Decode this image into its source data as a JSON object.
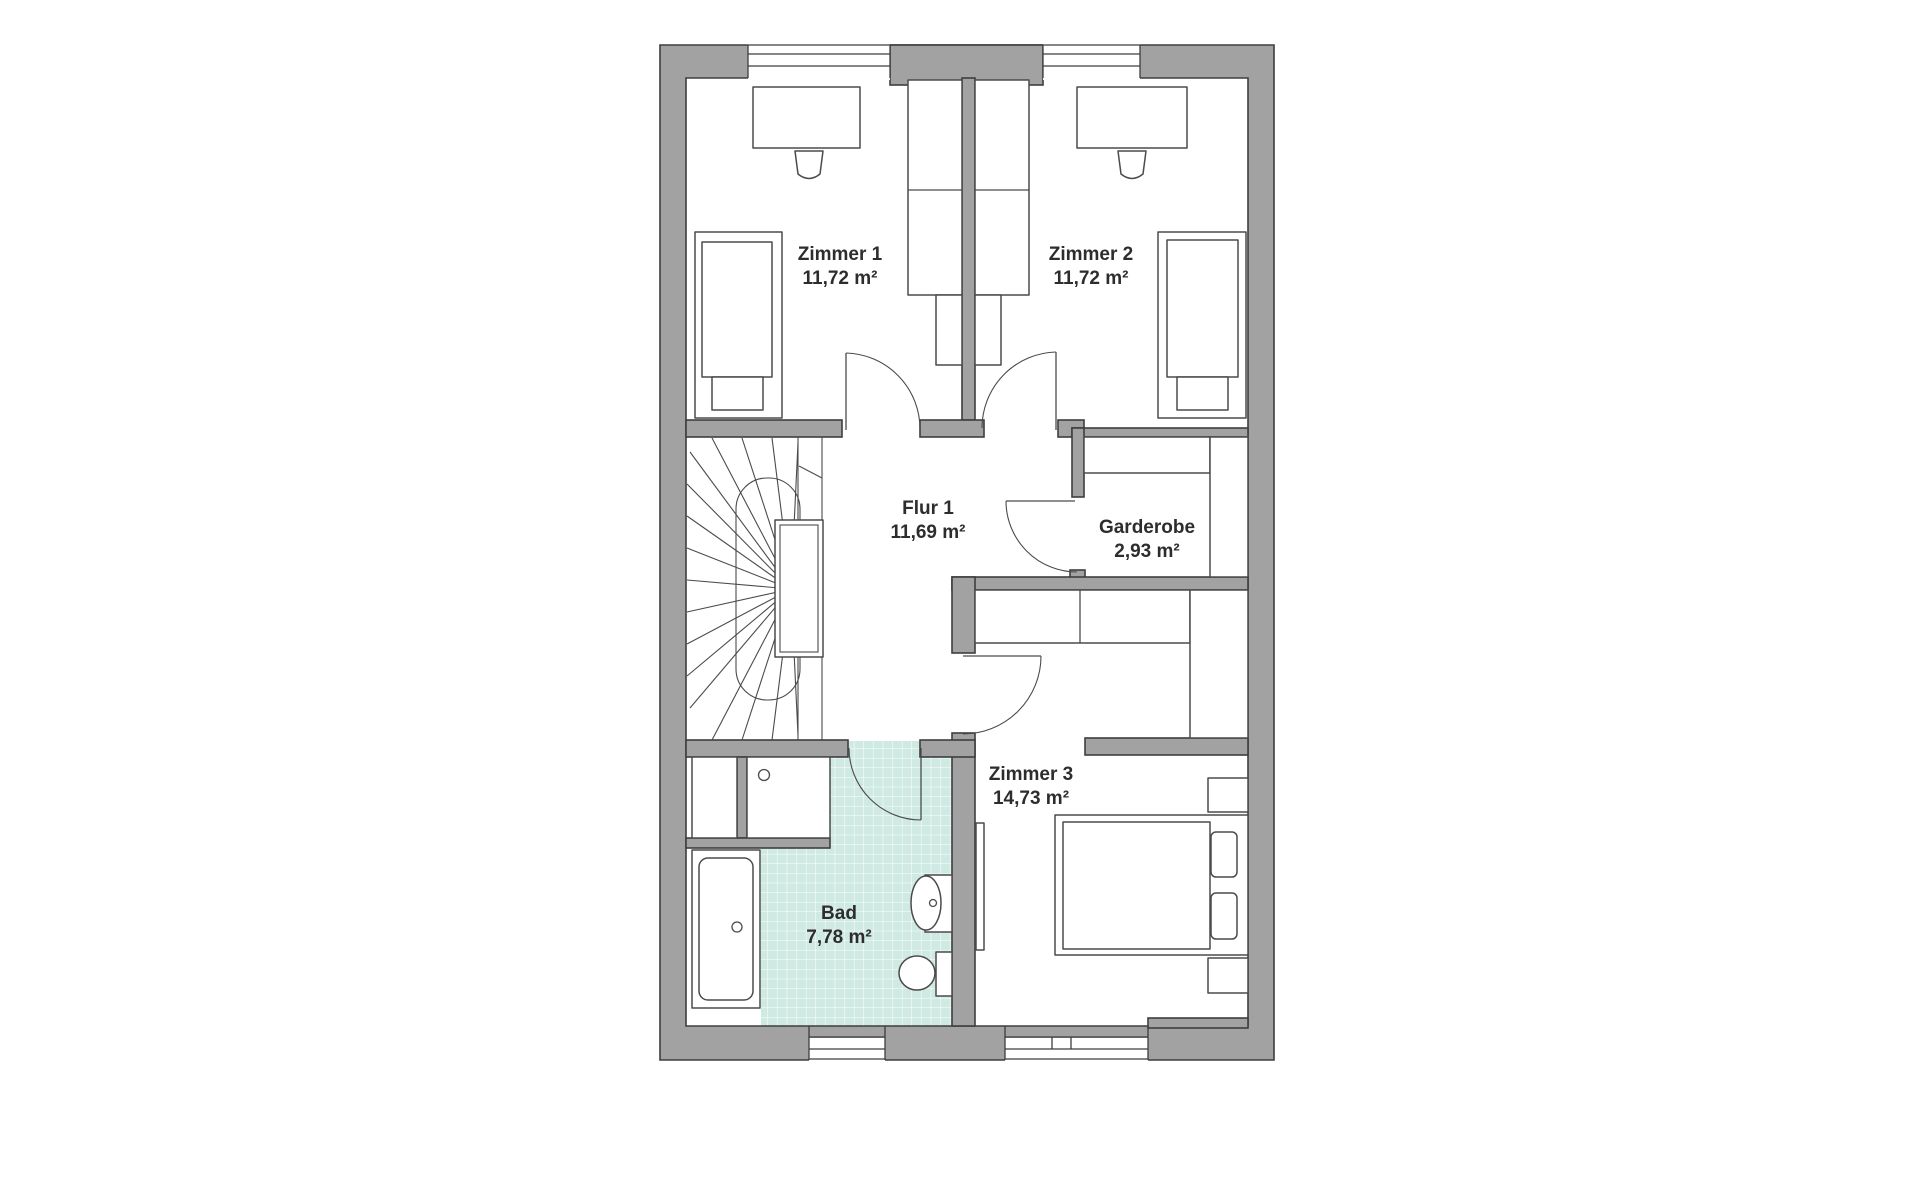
{
  "rooms": {
    "zimmer1": {
      "name": "Zimmer 1",
      "area": "11,72 m²"
    },
    "zimmer2": {
      "name": "Zimmer 2",
      "area": "11,72 m²"
    },
    "flur1": {
      "name": "Flur 1",
      "area": "11,69 m²"
    },
    "garderobe": {
      "name": "Garderobe",
      "area": "2,93 m²"
    },
    "zimmer3": {
      "name": "Zimmer 3",
      "area": "14,73 m²"
    },
    "bad": {
      "name": "Bad",
      "area": "7,78 m²"
    }
  },
  "colors": {
    "background": "#ffffff",
    "wall_fill": "#a2a2a2",
    "wall_stroke": "#3e3e3e",
    "furniture_stroke": "#4b4b4b",
    "label_color": "#2d2d2d",
    "tile_fill": "#cfe9e3",
    "tile_grid": "#ffffff"
  }
}
